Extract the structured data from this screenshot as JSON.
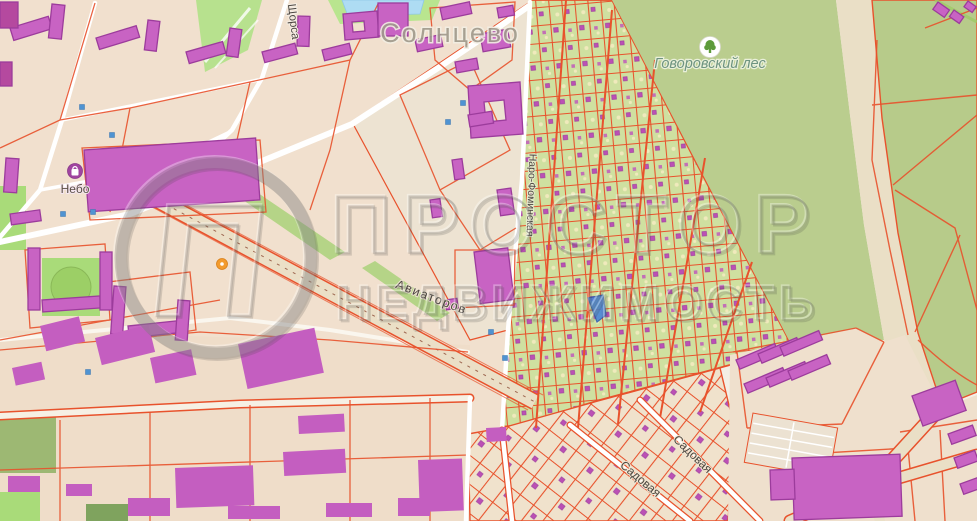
{
  "canvas": {
    "width": 977,
    "height": 521
  },
  "labels": {
    "district": "Солнцево",
    "forest": "Говоровский лес",
    "mall": "Небо",
    "streets": [
      {
        "name": "Щорса"
      },
      {
        "name": "Авиаторов"
      },
      {
        "name": "Наро-Фоминская"
      },
      {
        "name": "Садовая"
      },
      {
        "name": "Садовая"
      }
    ]
  },
  "watermark": {
    "brand": "ПРОСТОР",
    "brand_sub": "НЕДВИЖИМОСТЬ",
    "logo_glyph": "П"
  },
  "colors": {
    "cadastral_line": "#e8522c",
    "building_fill": "#c863c3",
    "building_stroke": "#9c3c9c",
    "urban_block": "#f1e0ce",
    "garden_green": "#cfe0a0",
    "forest_green": "#bacd8e",
    "park_green": "#a9db79",
    "road_white": "#ffffff",
    "pond_blue": "#aedcf3",
    "selected_parcel_blue": "#4a86d8",
    "poi_marker_blue": "#4f93d2",
    "poi_marker_orange": "#f39b2d",
    "forest_label_color": "#6e9480",
    "street_label_color": "#4c4640",
    "district_label_color": "#a09a8c",
    "watermark_gray": "rgba(100,100,100,0.55)"
  }
}
